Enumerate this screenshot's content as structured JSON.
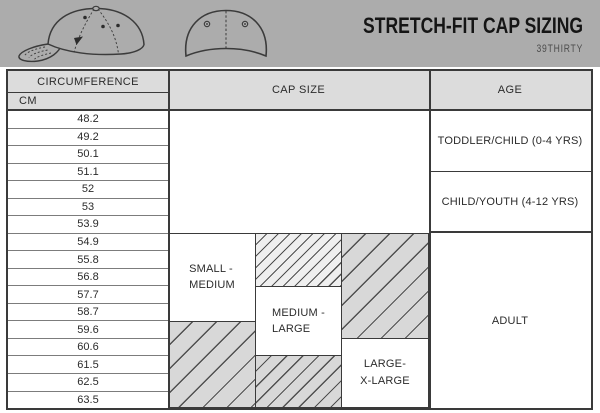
{
  "banner": {
    "title": "STRETCH-FIT CAP SIZING",
    "subtitle": "39THIRTY",
    "illustrations": [
      "cap-side-view",
      "cap-back-view"
    ]
  },
  "table": {
    "headers": {
      "circumference": "CIRCUMFERENCE",
      "unit": "CM",
      "cap_size": "CAP SIZE",
      "age": "AGE"
    },
    "cm_values": [
      "48.2",
      "49.2",
      "50.1",
      "51.1",
      "52",
      "53",
      "53.9",
      "54.9",
      "55.8",
      "56.8",
      "57.7",
      "58.7",
      "59.6",
      "60.6",
      "61.5",
      "62.5",
      "63.5"
    ],
    "sizes": [
      {
        "line1": "SMALL -",
        "line2": "MEDIUM"
      },
      {
        "line1": "MEDIUM -",
        "line2": "LARGE"
      },
      {
        "line1": "LARGE-",
        "line2": "X-LARGE"
      }
    ],
    "ages": [
      {
        "label": "TODDLER/CHILD (0-4 YRS)"
      },
      {
        "label": "CHILD/YOUTH (4-12 YRS)"
      },
      {
        "label": "ADULT"
      }
    ]
  },
  "colors": {
    "banner_bg": "#acacac",
    "header_cell_bg": "#dcdcdc",
    "hatch_bg": "#d8d8d8",
    "hatch_line": "#4f4f4f",
    "border_dark": "#3a3a3a"
  },
  "chart_data": {
    "type": "table",
    "title": "STRETCH-FIT CAP SIZING",
    "subtitle": "39THIRTY",
    "cm_values": [
      48.2,
      49.2,
      50.1,
      51.1,
      52,
      53,
      53.9,
      54.9,
      55.8,
      56.8,
      57.7,
      58.7,
      59.6,
      60.6,
      61.5,
      62.5,
      63.5
    ],
    "cap_sizes": [
      {
        "name": "SMALL - MEDIUM",
        "label_range_cm": [
          54.9,
          58.7
        ],
        "hatched_ranges_cm": [
          [
            59.6,
            63.5
          ]
        ]
      },
      {
        "name": "MEDIUM - LARGE",
        "label_range_cm": [
          57.7,
          60.6
        ],
        "hatched_ranges_cm": [
          [
            54.9,
            56.8
          ],
          [
            61.5,
            63.5
          ]
        ]
      },
      {
        "name": "LARGE-X-LARGE",
        "label_range_cm": [
          60.6,
          63.5
        ],
        "hatched_ranges_cm": [
          [
            54.9,
            59.6
          ]
        ]
      }
    ],
    "ages": [
      {
        "name": "TODDLER/CHILD (0-4 YRS)",
        "cm_range": [
          48.2,
          51.1
        ]
      },
      {
        "name": "CHILD/YOUTH (4-12 YRS)",
        "cm_range": [
          51.1,
          53.9
        ]
      },
      {
        "name": "ADULT",
        "cm_range": [
          54.9,
          63.5
        ]
      }
    ]
  }
}
